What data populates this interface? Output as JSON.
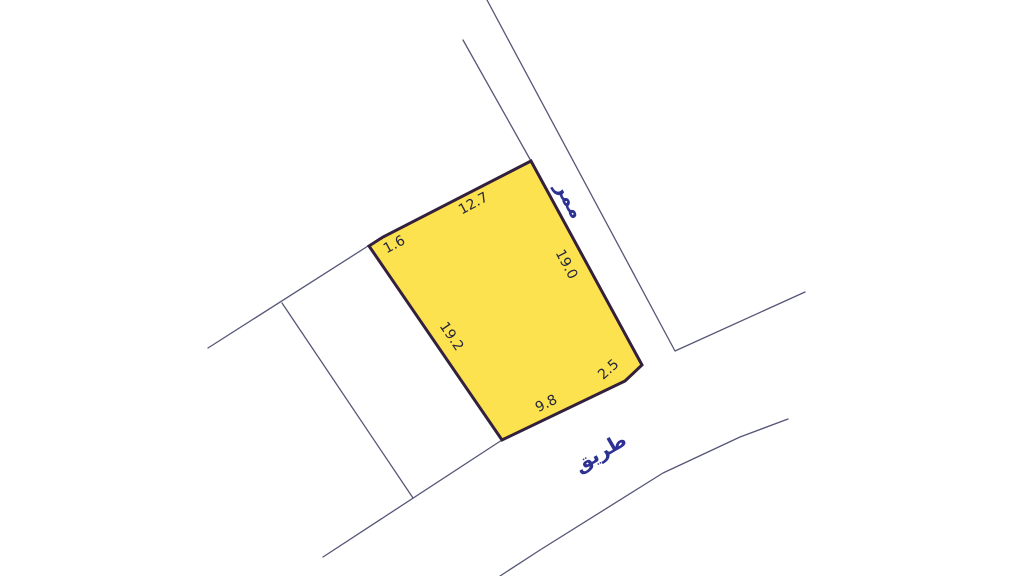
{
  "colors": {
    "background": "#ffffff",
    "parcel_fill": "#FBE24E",
    "parcel_outline": "#32203C",
    "boundary_line": "#565678",
    "dimension_text": "#26263A",
    "street_text": "#2C3192"
  },
  "parcel": {
    "dimensions": {
      "top": "12.7",
      "top_left_chamfer": "1.6",
      "left": "19.2",
      "right": "19.0",
      "bottom": "9.8",
      "bottom_right_chamfer": "2.5"
    }
  },
  "streets": {
    "passage_label": "ممر",
    "road_label": "طريق"
  }
}
